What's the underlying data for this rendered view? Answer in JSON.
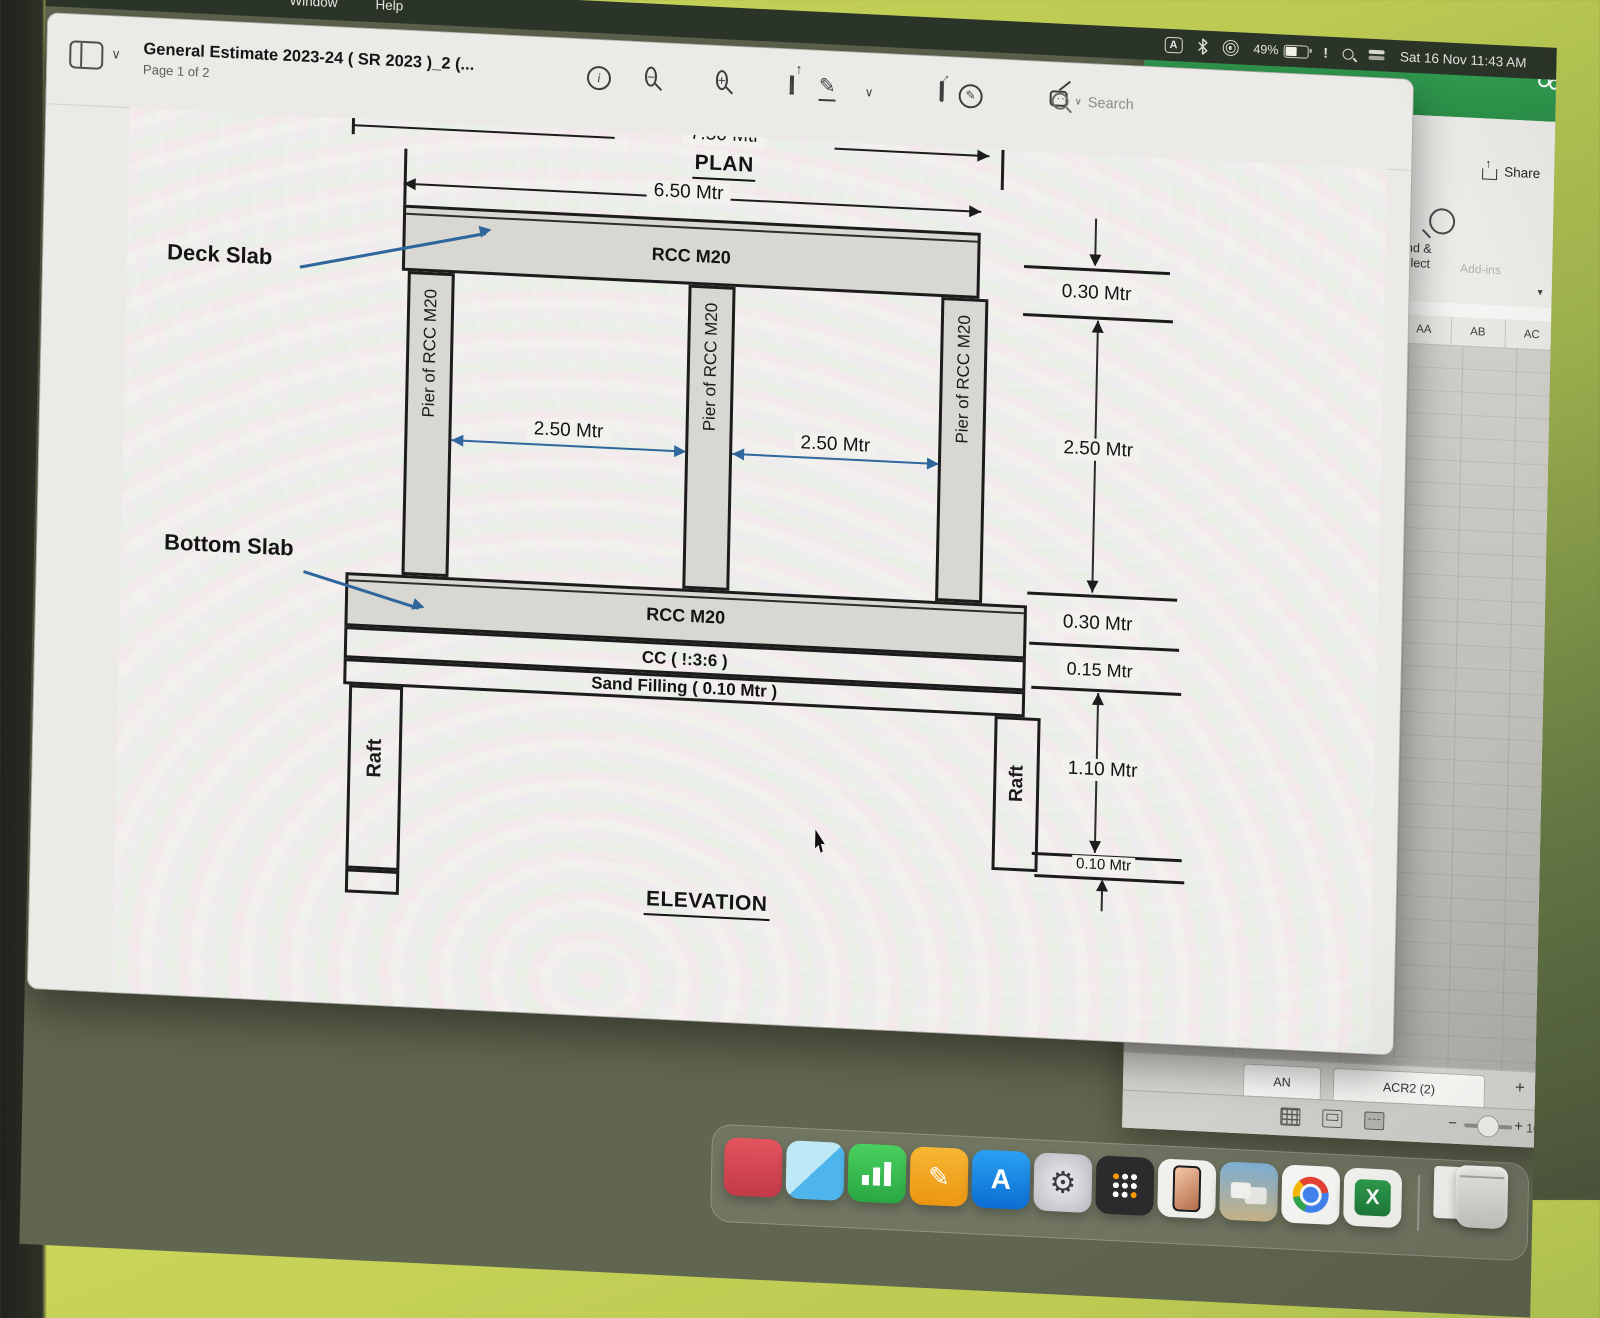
{
  "menu_bar": {
    "menus": [
      {
        "label": "Window"
      },
      {
        "label": "Help"
      }
    ],
    "status": {
      "input_label": "A",
      "battery_percent": "49%",
      "alert": "!",
      "clock": "Sat 16 Nov 11:43 AM"
    }
  },
  "preview_window": {
    "title": "General Estimate 2023-24 ( SR 2023 )_2 (...",
    "page_indicator": "Page 1 of 2",
    "search_placeholder": "Search"
  },
  "excel_window": {
    "share_label": "Share",
    "find_select_label_1": "Find &",
    "find_select_label_2": "Select",
    "addins_label": "Add-ins",
    "column_headers": [
      "AA",
      "AB",
      "AC",
      "AD"
    ],
    "sheet_tabs": [
      {
        "label": "AN"
      },
      {
        "label": "ACR2 (2)"
      }
    ],
    "new_sheet_label": "+",
    "zoom_minus": "−",
    "zoom_plus": "+",
    "zoom_value": "100"
  },
  "drawing": {
    "plan_dim": "7.50 Mtr",
    "plan_title": "PLAN",
    "deck_dim": "6.50 Mtr",
    "deck_slab_text": "RCC M20",
    "pier_text": "Pier of RCC M20",
    "span_dim_left": "2.50 Mtr",
    "span_dim_right": "2.50 Mtr",
    "bottom_slab_text": "RCC M20",
    "cc_text": "CC ( !:3:6 )",
    "sand_text": "Sand Filling ( 0.10 Mtr )",
    "raft_left": "Raft",
    "raft_right": "Raft",
    "elevation_title": "ELEVATION",
    "leader_deck": "Deck Slab",
    "leader_bottom": "Bottom Slab",
    "dims_right": [
      "0.30 Mtr",
      "2.50 Mtr",
      "0.30 Mtr",
      "0.15 Mtr",
      "1.10 Mtr",
      "0.10 Mtr"
    ]
  },
  "icons": {
    "info": "i",
    "chevron_down": "∨",
    "pencil": "✎",
    "sign_nib": "✎",
    "form_dots": "···",
    "gear": "⚙",
    "appstore_glyph": "A",
    "excel_glyph": "X",
    "pencil_white": "✎"
  },
  "dock": {
    "apps": [
      "red-app",
      "maps",
      "stocks",
      "pencil-app",
      "app-store",
      "system-settings",
      "calculator",
      "iphone-mirroring",
      "desktop-windows",
      "chrome",
      "excel",
      "downloads-file",
      "trash"
    ]
  },
  "colors": {
    "excel_green": "#2f9e4e",
    "leader_blue": "#2f669c",
    "menu_bar": "#2b3428",
    "page": "#f3f1ee",
    "drawing_ink": "#1c1c1c"
  }
}
